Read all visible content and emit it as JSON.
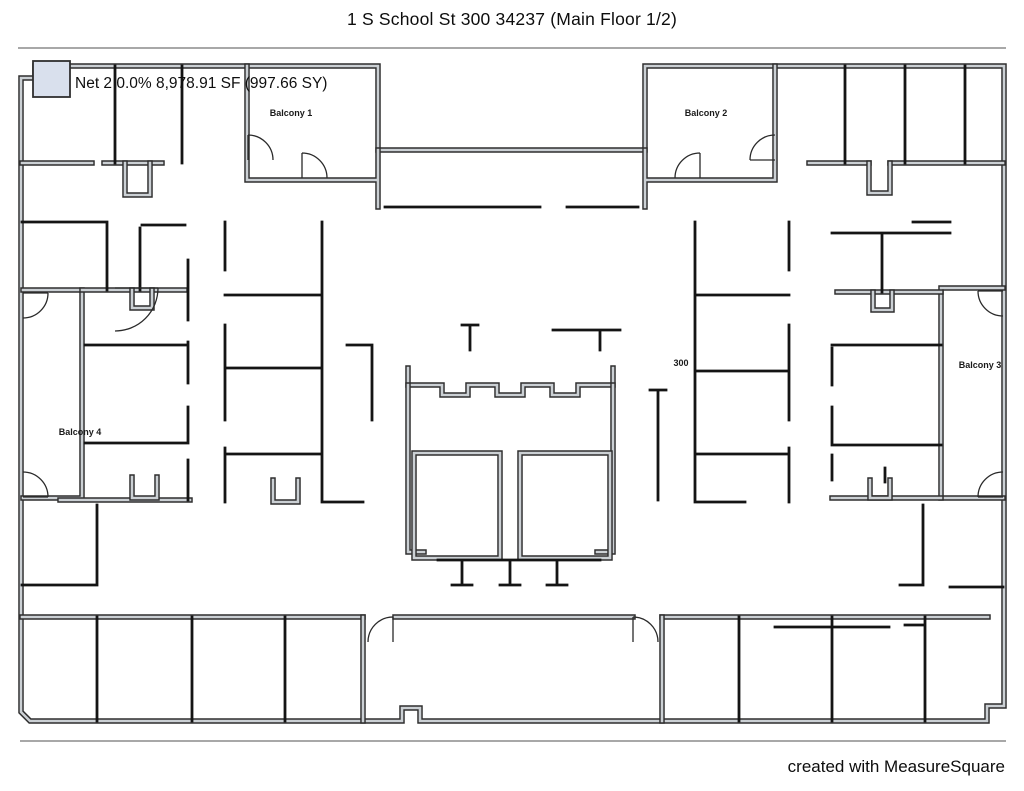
{
  "header": {
    "title": "1 S School St 300 34237 (Main Floor 1/2)"
  },
  "plan": {
    "net_label": "Net 2 0.0% 8,978.91 SF (997.66 SY)",
    "legend_color": "#d9e0ed",
    "wall_gray": "#cbd0d4",
    "wall_dark": "#141414",
    "labels": {
      "balcony1": "Balcony 1",
      "balcony2": "Balcony 2",
      "balcony3": "Balcony 3",
      "balcony4": "Balcony 4",
      "unit": "300"
    }
  },
  "footer": {
    "credit": "created with MeasureSquare"
  }
}
